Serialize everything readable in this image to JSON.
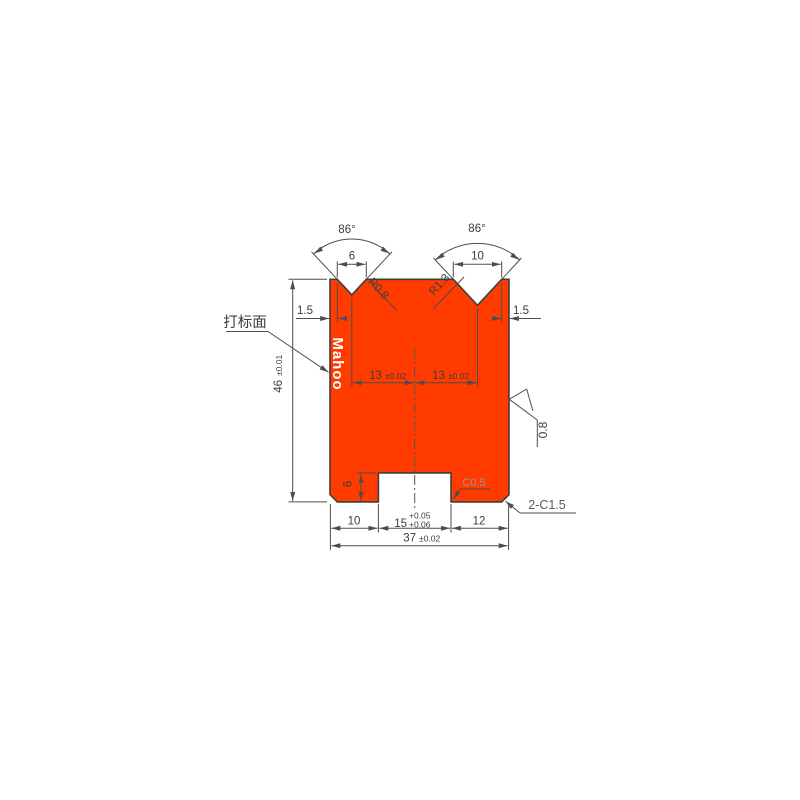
{
  "figure": {
    "watermark": "Mahoo",
    "marking_surface_label": "打标面",
    "angles": {
      "left": "86°",
      "right": "86°"
    },
    "top_dims": {
      "left_v_width": "6",
      "right_v_width": "10",
      "left_offset": "1.5",
      "right_offset": "1.5"
    },
    "radii": {
      "left": "R0.8",
      "right": "R1.3"
    },
    "mid_dims": {
      "left_pitch_value": "13",
      "left_pitch_tol": "±0.02",
      "right_pitch_value": "13",
      "right_pitch_tol": "±0.02"
    },
    "height_dim": {
      "value": "46",
      "tol": "±0.01"
    },
    "roughness": {
      "value": "0.8"
    },
    "slot": {
      "depth": "6",
      "chamfer": "C0.5"
    },
    "bottom_dims": {
      "left": "10",
      "mid_value": "15",
      "mid_tol_upper": "+0.05",
      "mid_tol_lower": "+0.06",
      "right": "12",
      "total_value": "37",
      "total_tol": "±0.02"
    },
    "corner_chamfer": "2-C1.5",
    "colors": {
      "body_fill": "#FF3B00",
      "outline": "#3F3F3F",
      "dimension": "#4D4D4D",
      "watermark_text": "#FFFFFF"
    }
  }
}
